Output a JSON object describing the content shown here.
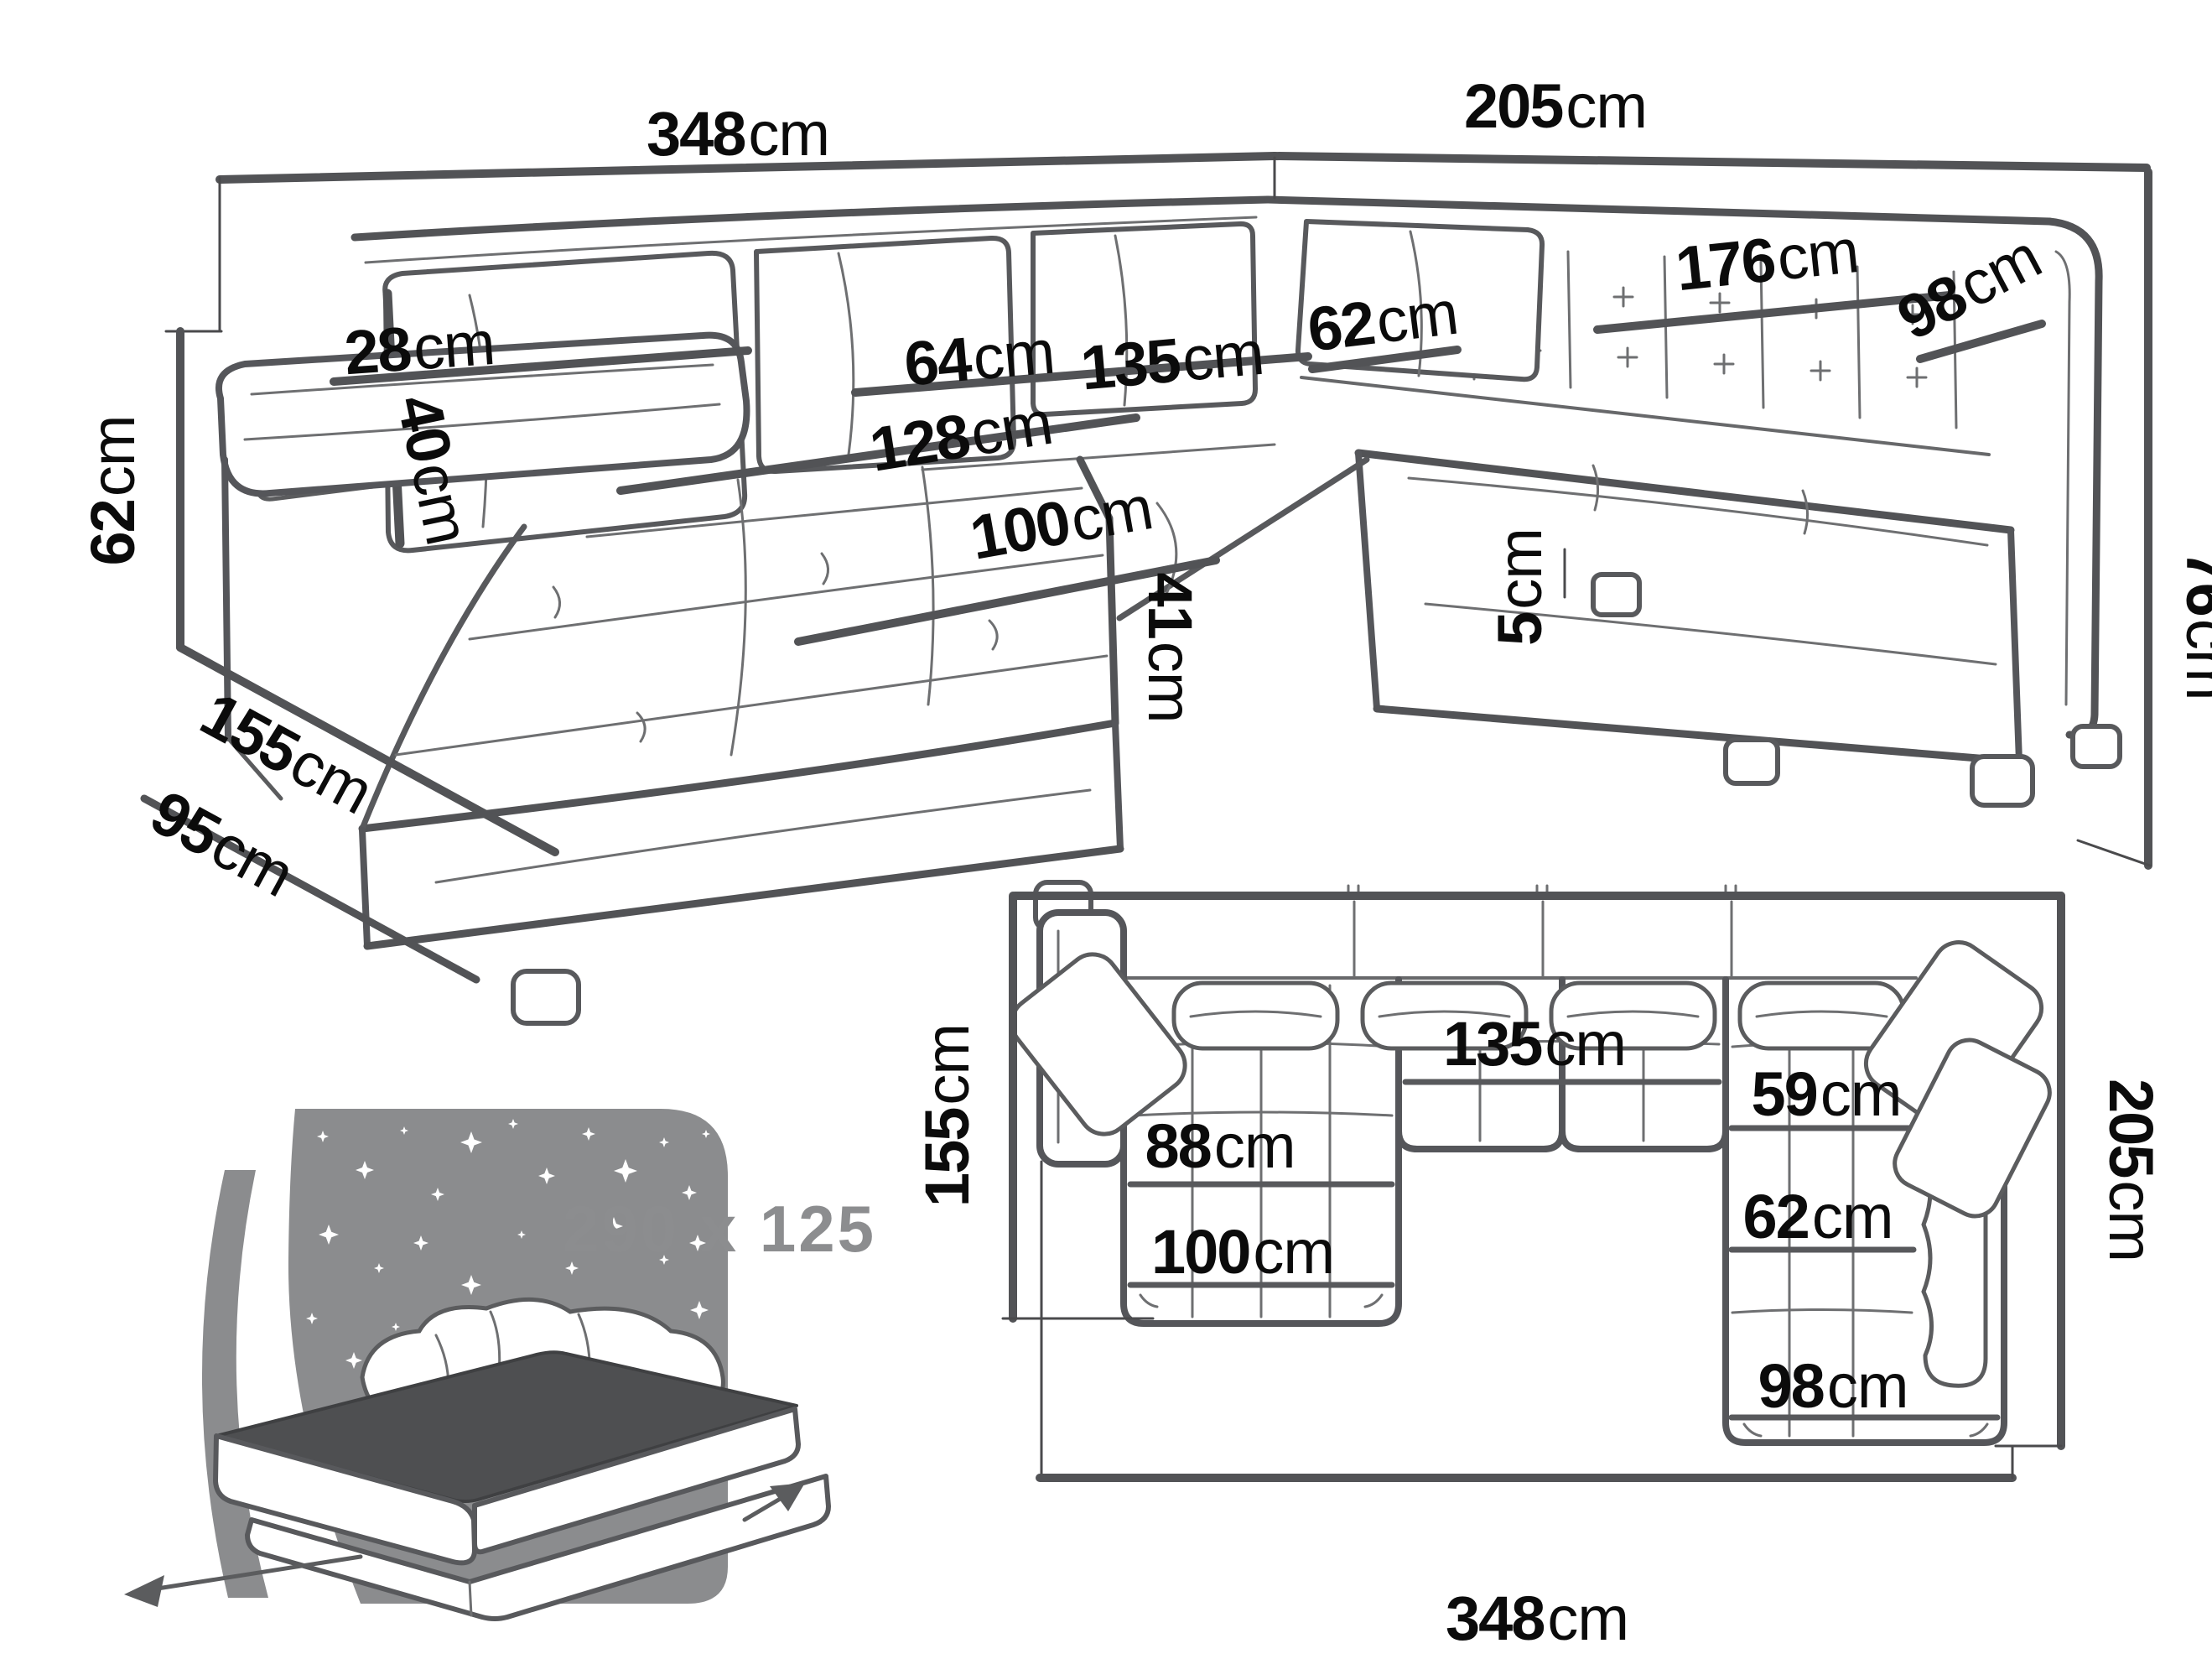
{
  "page": {
    "title": "U-shaped corner sofa dimensions diagram",
    "background": "#ffffff"
  },
  "colors": {
    "line_dark": "#525356",
    "line_mid": "#6e6f71",
    "label_black": "#0b0b0b",
    "icon_gray": "#8b8c8e",
    "bed_top_gray": "#4e4f51",
    "size_text_gray": "#8c8d8f"
  },
  "perspective_view": {
    "name": "U-shaped sofa - perspective view with dimensions",
    "labels": {
      "width_total": {
        "num": "348",
        "unit": "cm"
      },
      "depth_right": {
        "num": "205",
        "unit": "cm"
      },
      "back_cushion": {
        "num": "40",
        "unit": "cm"
      },
      "armrest_width": {
        "num": "28",
        "unit": "cm"
      },
      "seat_height": {
        "num": "62",
        "unit": "cm"
      },
      "side_length": {
        "num": "95",
        "unit": "cm"
      },
      "depth_left": {
        "num": "155",
        "unit": "cm"
      },
      "seat_depth": {
        "num": "64",
        "unit": "cm"
      },
      "corner_seat_width": {
        "num": "135",
        "unit": "cm"
      },
      "chaise_length": {
        "num": "128",
        "unit": "cm"
      },
      "chaise_width": {
        "num": "100",
        "unit": "cm"
      },
      "seat_front_height": {
        "num": "41",
        "unit": "cm"
      },
      "right_seat_depth": {
        "num": "62",
        "unit": "cm"
      },
      "right_seat_length": {
        "num": "176",
        "unit": "cm"
      },
      "right_front_width": {
        "num": "98",
        "unit": "cm"
      },
      "backrest_height": {
        "num": "76",
        "unit": "cm"
      },
      "leg_height": {
        "num": "5",
        "unit": "cm"
      }
    }
  },
  "top_view": {
    "name": "U-shaped sofa - top view floor plan",
    "labels": {
      "depth_left": {
        "num": "155",
        "unit": "cm"
      },
      "chaise_inner": {
        "num": "88",
        "unit": "cm"
      },
      "corner_seat_width": {
        "num": "135",
        "unit": "cm"
      },
      "right_inner": {
        "num": "59",
        "unit": "cm"
      },
      "right_seat_width": {
        "num": "62",
        "unit": "cm"
      },
      "chaise_width": {
        "num": "100",
        "unit": "cm"
      },
      "right_front_width": {
        "num": "98",
        "unit": "cm"
      },
      "depth_right": {
        "num": "205",
        "unit": "cm"
      },
      "width_total": {
        "num": "348",
        "unit": "cm"
      }
    }
  },
  "sleeping_function": {
    "name": "fold-out sleeping surface size",
    "label": "290 x 125"
  }
}
